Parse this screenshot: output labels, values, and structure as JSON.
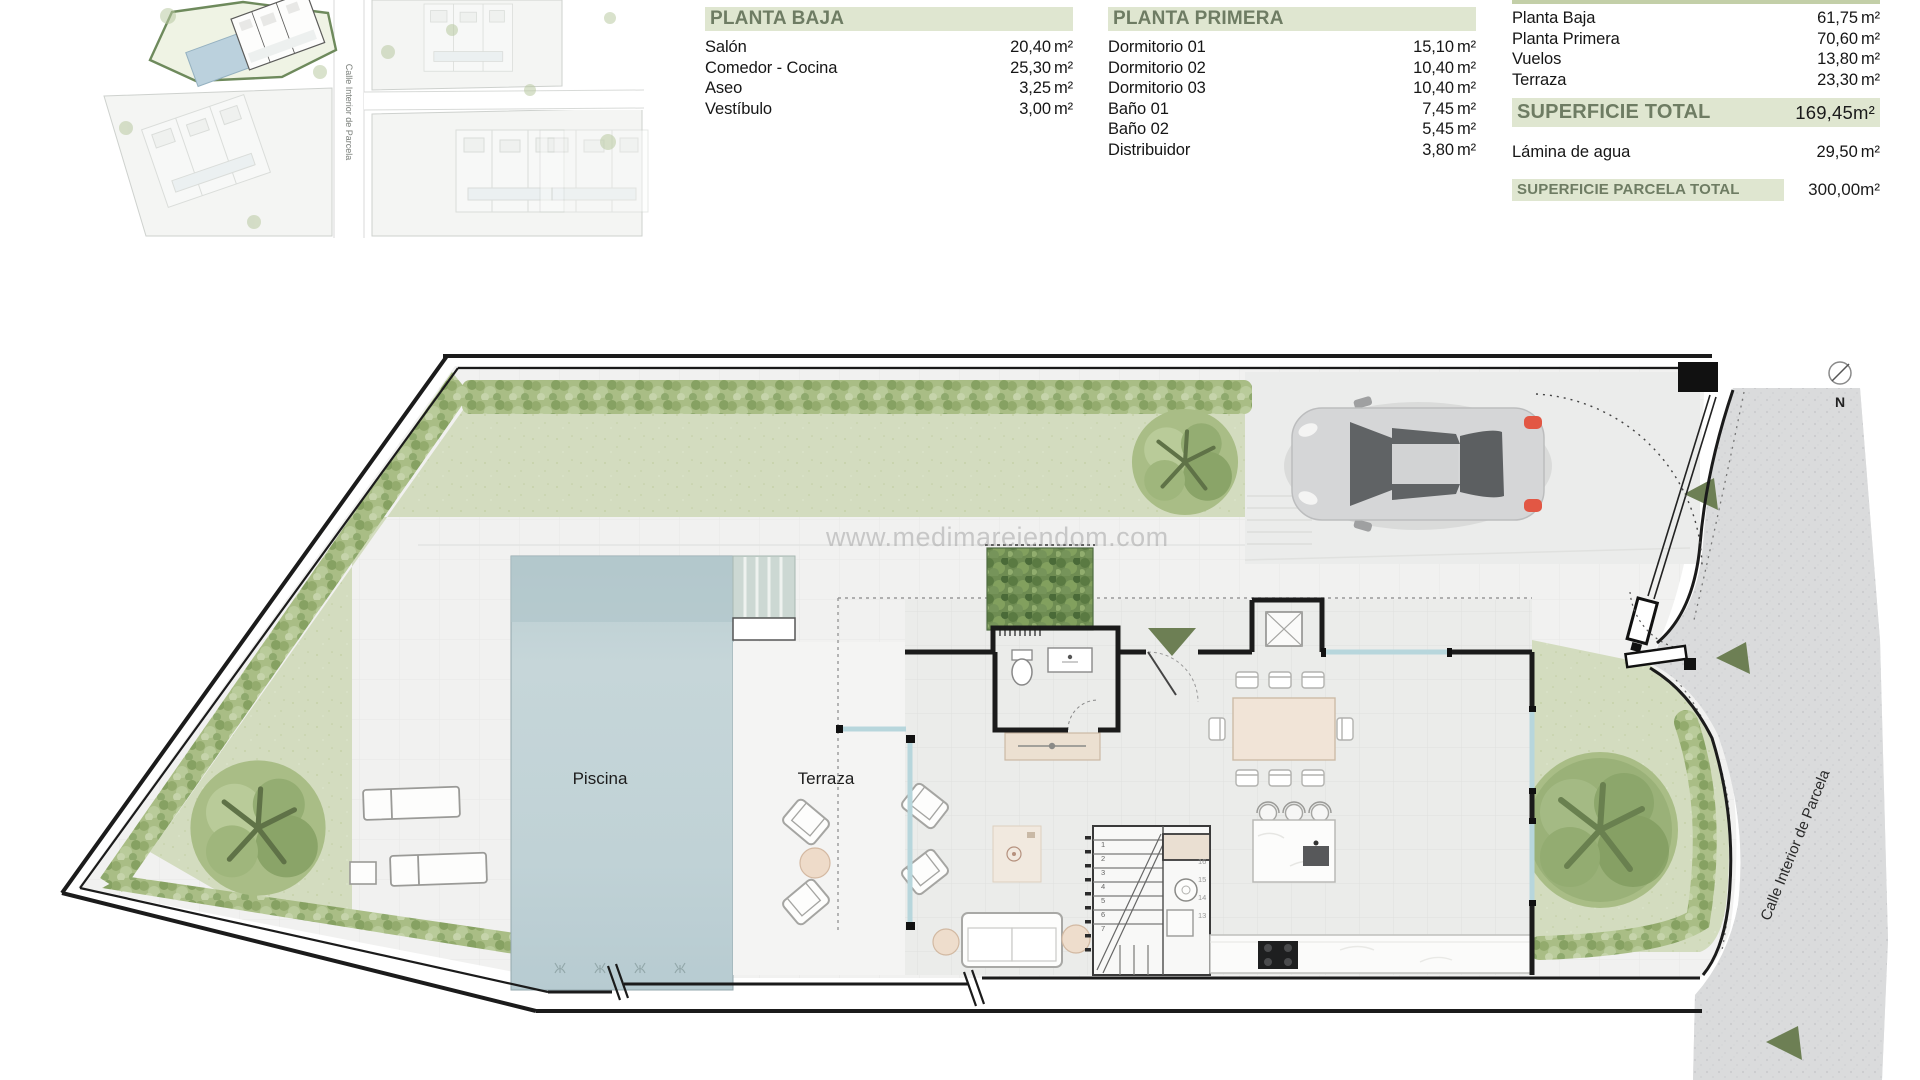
{
  "site_plan": {
    "street_label": "Calle Interior de Parcela"
  },
  "tables": {
    "planta_baja": {
      "title": "PLANTA BAJA",
      "rows": [
        {
          "label": "Salón",
          "value": "20,40",
          "unit": "m²"
        },
        {
          "label": "Comedor - Cocina",
          "value": "25,30",
          "unit": "m²"
        },
        {
          "label": "Aseo",
          "value": "3,25",
          "unit": "m²"
        },
        {
          "label": "Vestíbulo",
          "value": "3,00",
          "unit": "m²"
        }
      ]
    },
    "planta_primera": {
      "title": "PLANTA PRIMERA",
      "rows": [
        {
          "label": "Dormitorio 01",
          "value": "15,10",
          "unit": "m²"
        },
        {
          "label": "Dormitorio 02",
          "value": "10,40",
          "unit": "m²"
        },
        {
          "label": "Dormitorio 03",
          "value": "10,40",
          "unit": "m²"
        },
        {
          "label": "Baño 01",
          "value": "7,45",
          "unit": "m²"
        },
        {
          "label": "Baño 02",
          "value": "5,45",
          "unit": "m²"
        },
        {
          "label": "Distribuidor",
          "value": "3,80",
          "unit": "m²"
        }
      ]
    },
    "resumen": {
      "rows": [
        {
          "label": "Planta Baja",
          "value": "61,75",
          "unit": "m²"
        },
        {
          "label": "Planta Primera",
          "value": "70,60",
          "unit": "m²"
        },
        {
          "label": "Vuelos",
          "value": "13,80",
          "unit": "m²"
        },
        {
          "label": "Terraza",
          "value": "23,30",
          "unit": "m²"
        }
      ],
      "total_label": "SUPERFICIE TOTAL",
      "total_value": "169,45",
      "total_unit": "m²",
      "lamina_label": "Lámina de agua",
      "lamina_value": "29,50",
      "lamina_unit": "m²",
      "parcela_label": "SUPERFICIE PARCELA TOTAL",
      "parcela_value": "300,00",
      "parcela_unit": "m²"
    }
  },
  "watermark": "www.medimareiendom.com",
  "plan": {
    "labels": {
      "piscina": "Piscina",
      "terraza": "Terraza",
      "street": "Calle Interior de Parcela",
      "north": "N"
    },
    "stair_numbers": [
      "1",
      "2",
      "3",
      "4",
      "5",
      "6",
      "7"
    ],
    "stair_numbers_right": [
      "16",
      "15",
      "14",
      "13"
    ]
  },
  "colors": {
    "header_band": "#dfe6d0",
    "header_text": "#6e7c63",
    "lawn": "#d3dcbf",
    "hedge": "#a9bd85",
    "pool": "#c3d4d8",
    "street": "#dadbdc",
    "accent_green_dark": "#6d7f54",
    "wall": "#1b1b1b",
    "glass": "#b7d6dc"
  }
}
